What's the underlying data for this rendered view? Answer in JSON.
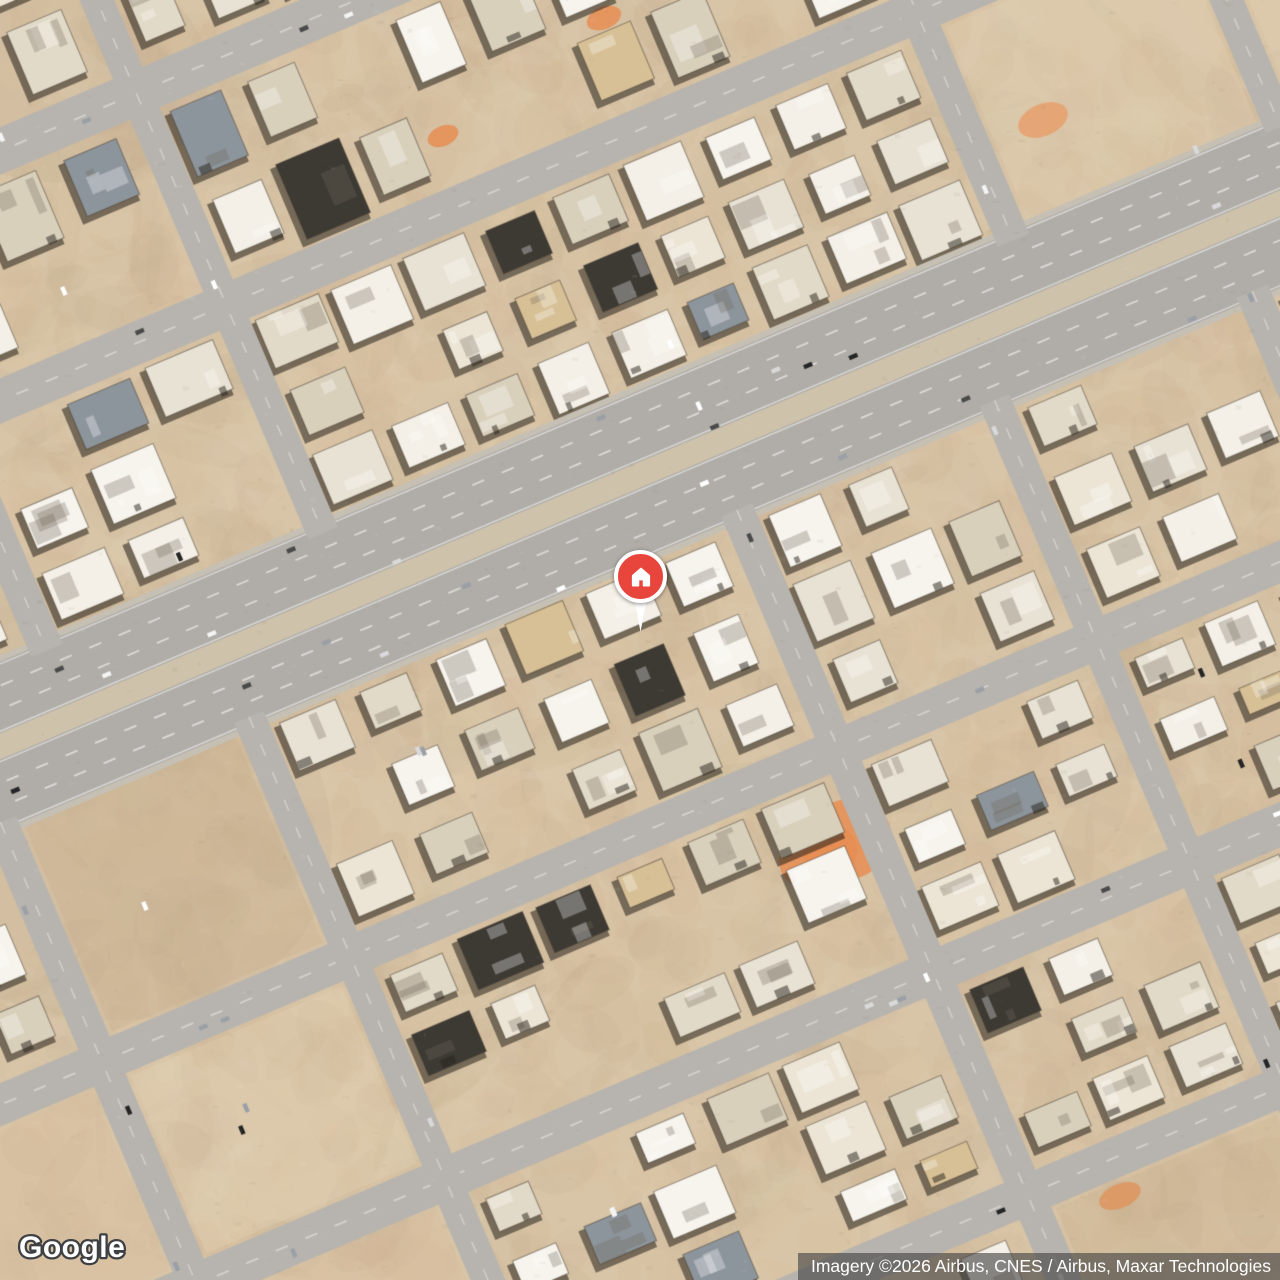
{
  "app": {
    "type": "satellite-map-embed"
  },
  "branding": {
    "logo_text": "Google"
  },
  "attribution": {
    "text": "Imagery ©2026 Airbus, CNES / Airbus, Maxar Technologies"
  },
  "marker": {
    "kind": "property-home-pin",
    "pin_color": "#e8453c",
    "ring_color": "#ffffff",
    "icon": "home-icon",
    "screen_x": 640,
    "screen_y": 632
  },
  "map": {
    "view": "satellite",
    "rotation_deg": -23,
    "palette": {
      "sand": "#d8c4a6",
      "sand_light": "#e6d6bc",
      "sand_dark": "#c4aa88",
      "sand_pink": "#dbbc9a",
      "sand_rock": "#bfa88b",
      "orange_dirt": "#e88d52",
      "road": "#b0ada8",
      "road_minor": "#b7b4af",
      "median": "#cec2ab",
      "lane_line": "#ffffff",
      "roof_whites": [
        "#f4f0e7",
        "#ece5d6",
        "#e2dac8",
        "#f7f4ed",
        "#d9d0bc",
        "#e8e2d4"
      ],
      "roof_dark": "#3d3a34",
      "roof_gray": "#8d959c",
      "roof_tan": "#d7c096",
      "shadow": "rgba(38,33,26,0.55)",
      "car_colors": [
        "#ffffff",
        "#f4f4f4",
        "#252525",
        "#9aa0a6",
        "#d9d9d9",
        "#4a4a4a"
      ]
    }
  }
}
